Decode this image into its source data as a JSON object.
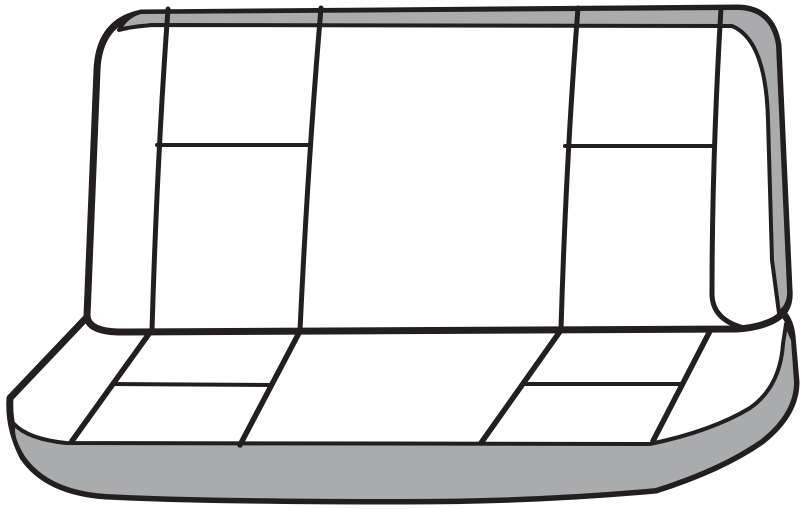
{
  "canvas": {
    "width": 800,
    "height": 509,
    "background": "#ffffff"
  },
  "illustration": {
    "subject": "Rear bench seat line-art illustration",
    "view": "front three-quarter view, seat back upright with bench cushion below",
    "colors": {
      "outline": "#231f20",
      "trim": "#a9abad",
      "surface": "#ffffff",
      "bg": "#ffffff"
    },
    "components": {
      "seat_back": {
        "label": "seat back (backrest)",
        "trim_band": "shaded band along top edge wrapping down the right edge",
        "vertical_seams": 4,
        "horizontal_seams": 2,
        "panels": 7
      },
      "seat_cushion": {
        "label": "bench seat cushion",
        "trim_band": "shaded skirt band along front bottom wrapping up the right side",
        "diagonal_seams": 4,
        "horizontal_seams": 2,
        "panels": 7
      }
    }
  }
}
